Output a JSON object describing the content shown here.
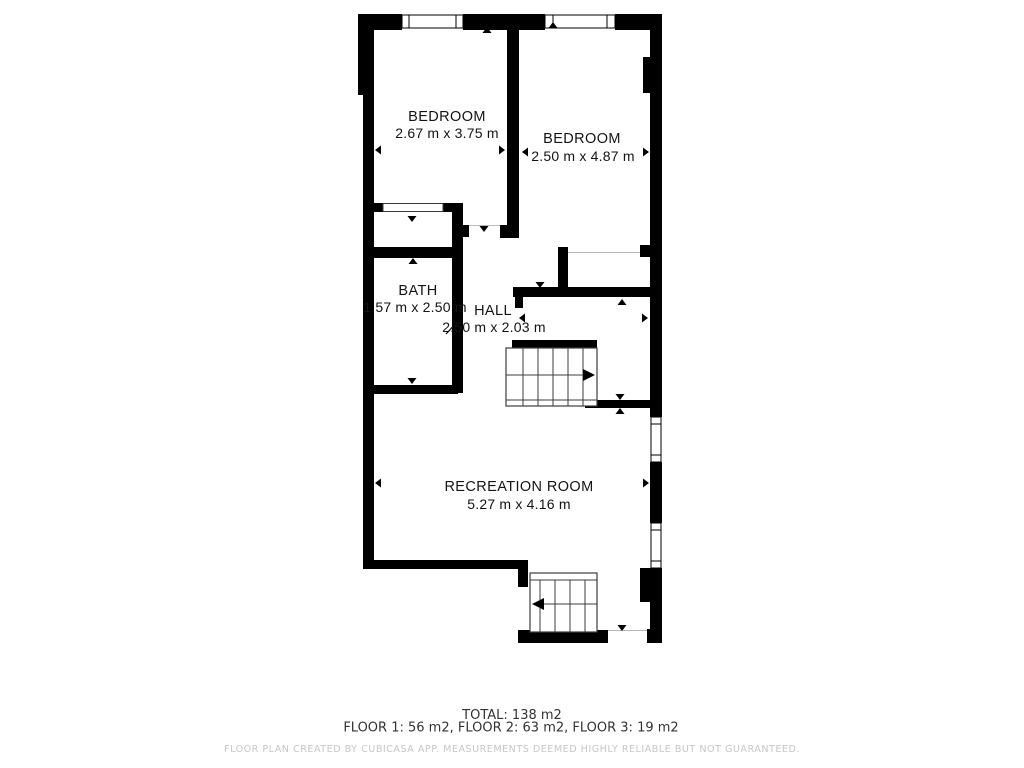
{
  "plan": {
    "rooms": [
      {
        "id": "bedroom-1",
        "name": "BEDROOM",
        "dims": "2.67 m x 3.75 m"
      },
      {
        "id": "bedroom-2",
        "name": "BEDROOM",
        "dims": "2.50 m x 4.87 m"
      },
      {
        "id": "bath",
        "name": "BATH",
        "dims": "1.57 m x 2.50 m"
      },
      {
        "id": "hall",
        "name": "HALL",
        "dims": "2.50 m x 2.03 m"
      },
      {
        "id": "recreation-room",
        "name": "RECREATION ROOM",
        "dims": "5.27 m x 4.16 m"
      }
    ],
    "stairs": [
      {
        "id": "stairs-upper",
        "direction": "right"
      },
      {
        "id": "stairs-lower",
        "direction": "left"
      }
    ],
    "summary": {
      "total": "TOTAL: 138 m2",
      "floors": "FLOOR 1: 56 m2, FLOOR 2: 63 m2, FLOOR 3: 19 m2"
    },
    "footer": "FLOOR PLAN CREATED BY CUBICASA APP. MEASUREMENTS DEEMED HIGHLY RELIABLE BUT NOT GUARANTEED.",
    "colors": {
      "wall": "#000000",
      "background": "#ffffff",
      "thin_line": "#b9b9b9",
      "text": "#141414",
      "summary_text": "#333333",
      "footer_text": "#c6c6c6"
    }
  }
}
